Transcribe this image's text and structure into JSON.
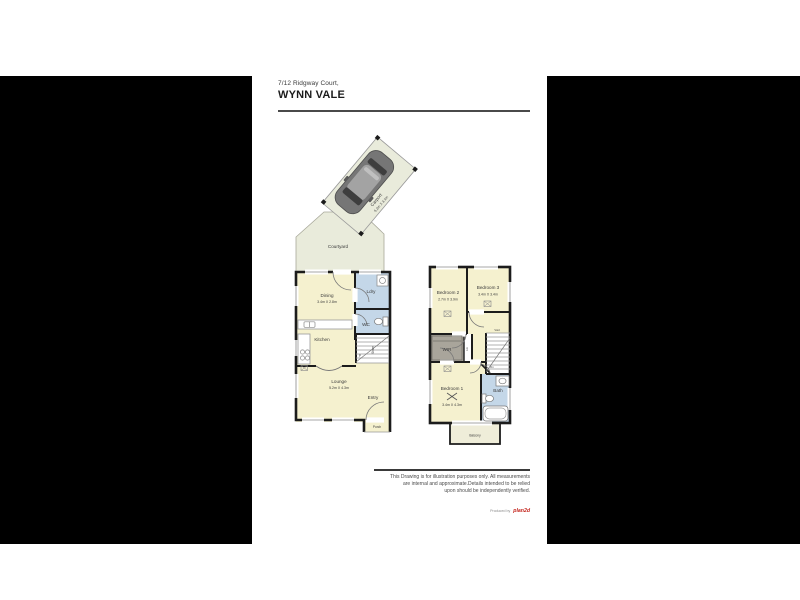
{
  "header": {
    "address": "7/12 Ridgway Court,",
    "suburb": "WYNN VALE"
  },
  "ground_floor": {
    "courtyard_label": "Courtyard",
    "carport_name": "Carport",
    "carport_dims": "5.2m X 3.1m",
    "dining_name": "Dining",
    "dining_dims": "3.4m X 2.8m",
    "kitchen_label": "Kitchen",
    "laundry_label": "Ldry",
    "wc_label": "WC",
    "store_label": "Store",
    "pantry_label": "P",
    "lounge_name": "Lounge",
    "lounge_dims": "5.2m X 4.3m",
    "entry_label": "Entry",
    "porch_label": "Porch"
  },
  "upper_floor": {
    "bedroom2_name": "Bedroom 2",
    "bedroom2_dims": "2.7m X 3.9m",
    "bedroom3_name": "Bedroom 3",
    "bedroom3_dims": "3.4m X 3.4m",
    "bedroom1_name": "Bedroom 1",
    "bedroom1_dims": "3.4m X 4.3m",
    "wir_label": "WIR",
    "linen_label": "Lin",
    "void_label": "Void",
    "down_label": "Dn",
    "bath_label": "Bath",
    "balcony_label": "Balcony"
  },
  "footer": {
    "disclaimer_line1": "This Drawing is for illustration purposes only. All measurements",
    "disclaimer_line2": "are internal and approximate.Details intended to be relied",
    "disclaimer_line3": "upon should be independently verified.",
    "produced_by": "Produced by",
    "brand": "plan2d"
  },
  "colors": {
    "room_fill": "#F5F1CF",
    "wet_area_fill": "#C4D7E8",
    "outdoor_fill": "#E9EBDB",
    "wir_fill": "#A9A59B",
    "wall": "#1C1C1C",
    "brand_red": "#C4241C"
  }
}
